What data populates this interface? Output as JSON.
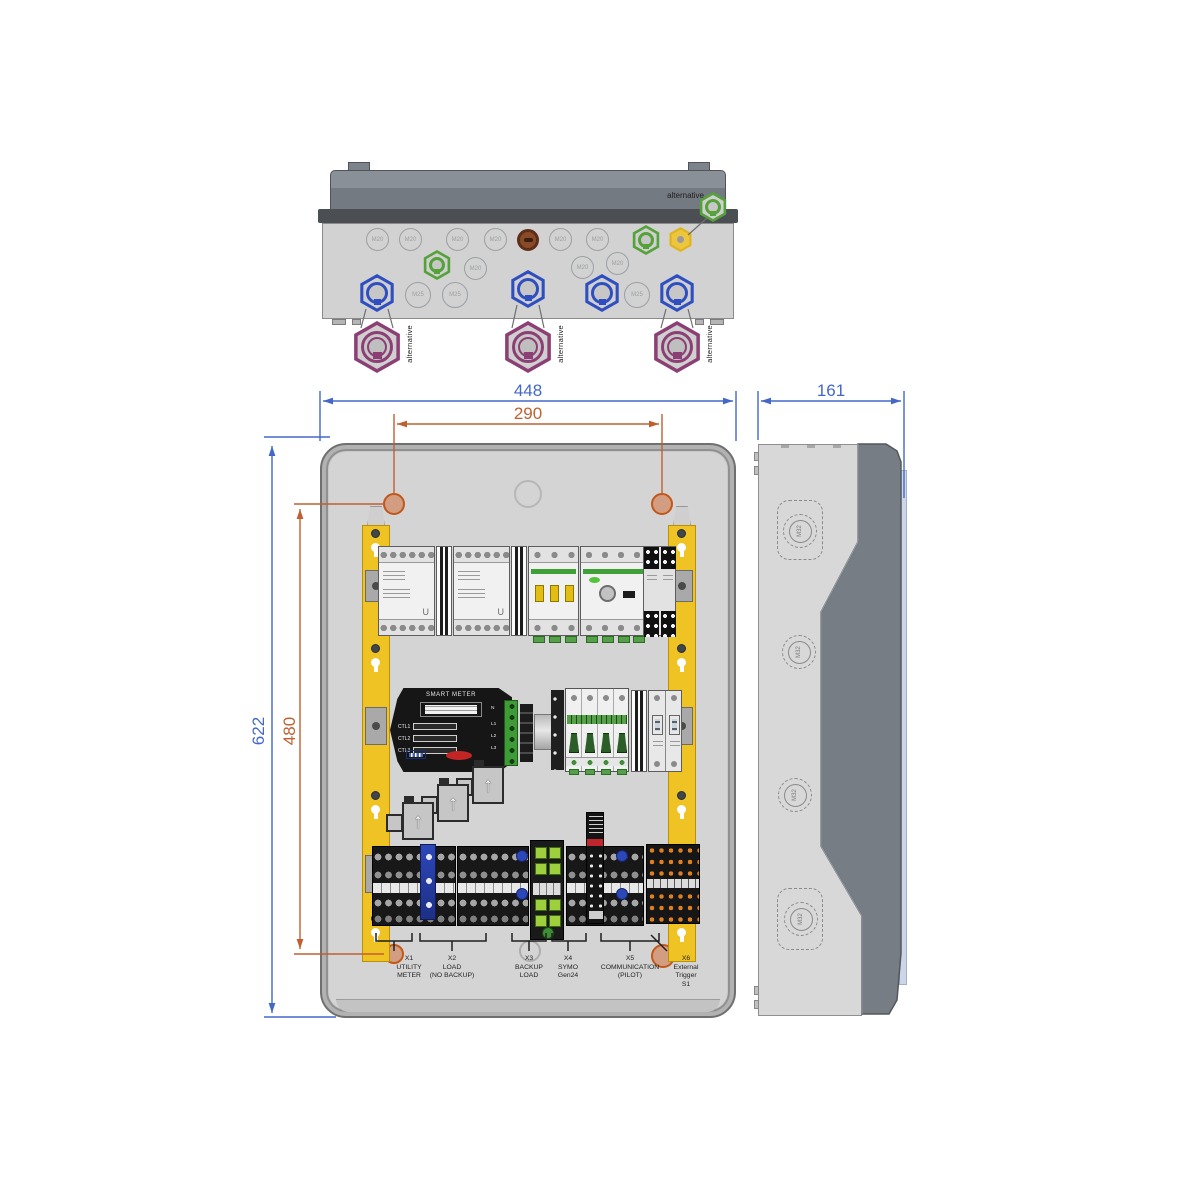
{
  "colors": {
    "dimension_blue": "#4468c8",
    "dimension_orange": "#c06030",
    "mount_hole_fill": "#d39d82",
    "enclosure_gray": "#d4d4d4",
    "lid_gray": "#757b83",
    "bracket_yellow": "#efc324",
    "gland_blue": "#2f4fc1",
    "gland_green": "#55a23a",
    "gland_purple": "#8c3f74",
    "gland_yellow": "#e2b31c",
    "earth_green": "#9ed03e",
    "comm_orange": "#e07f20",
    "smart_meter_black": "#161616"
  },
  "dimensions": {
    "front_width": "448",
    "mount_hole_spacing_width": "290",
    "front_height": "622",
    "mount_hole_spacing_height": "480",
    "side_depth": "161"
  },
  "top_view": {
    "alternative_label": "alternative",
    "m20_knockouts": [
      "M20",
      "M20",
      "M20",
      "M20",
      "M20",
      "M20",
      "M20",
      "M20",
      "M20"
    ],
    "m25_knockouts": [
      "M25",
      "M25",
      "M25"
    ]
  },
  "front_view": {
    "smart_meter": {
      "title": "SMART METER",
      "channels": [
        "CTL1",
        "CTL2",
        "CTL3"
      ],
      "terminals": [
        "N",
        "L1",
        "L2",
        "L3"
      ]
    },
    "contactor_mark": "U",
    "terminal_groups": [
      {
        "id": "X1",
        "lines": [
          "UTILITY",
          "METER"
        ]
      },
      {
        "id": "X2",
        "lines": [
          "LOAD",
          "(NO BACKUP)"
        ]
      },
      {
        "id": "X3",
        "lines": [
          "BACKUP",
          "LOAD"
        ]
      },
      {
        "id": "X4",
        "lines": [
          "SYMO",
          "Gen24"
        ]
      },
      {
        "id": "X5",
        "lines": [
          "COMMUNICATION",
          "(PILOT)"
        ]
      },
      {
        "id": "X6",
        "lines": [
          "External",
          "Trigger",
          "S1"
        ]
      }
    ]
  },
  "side_view": {
    "m32_knockouts": [
      "M32",
      "M32",
      "M32",
      "M32"
    ]
  }
}
